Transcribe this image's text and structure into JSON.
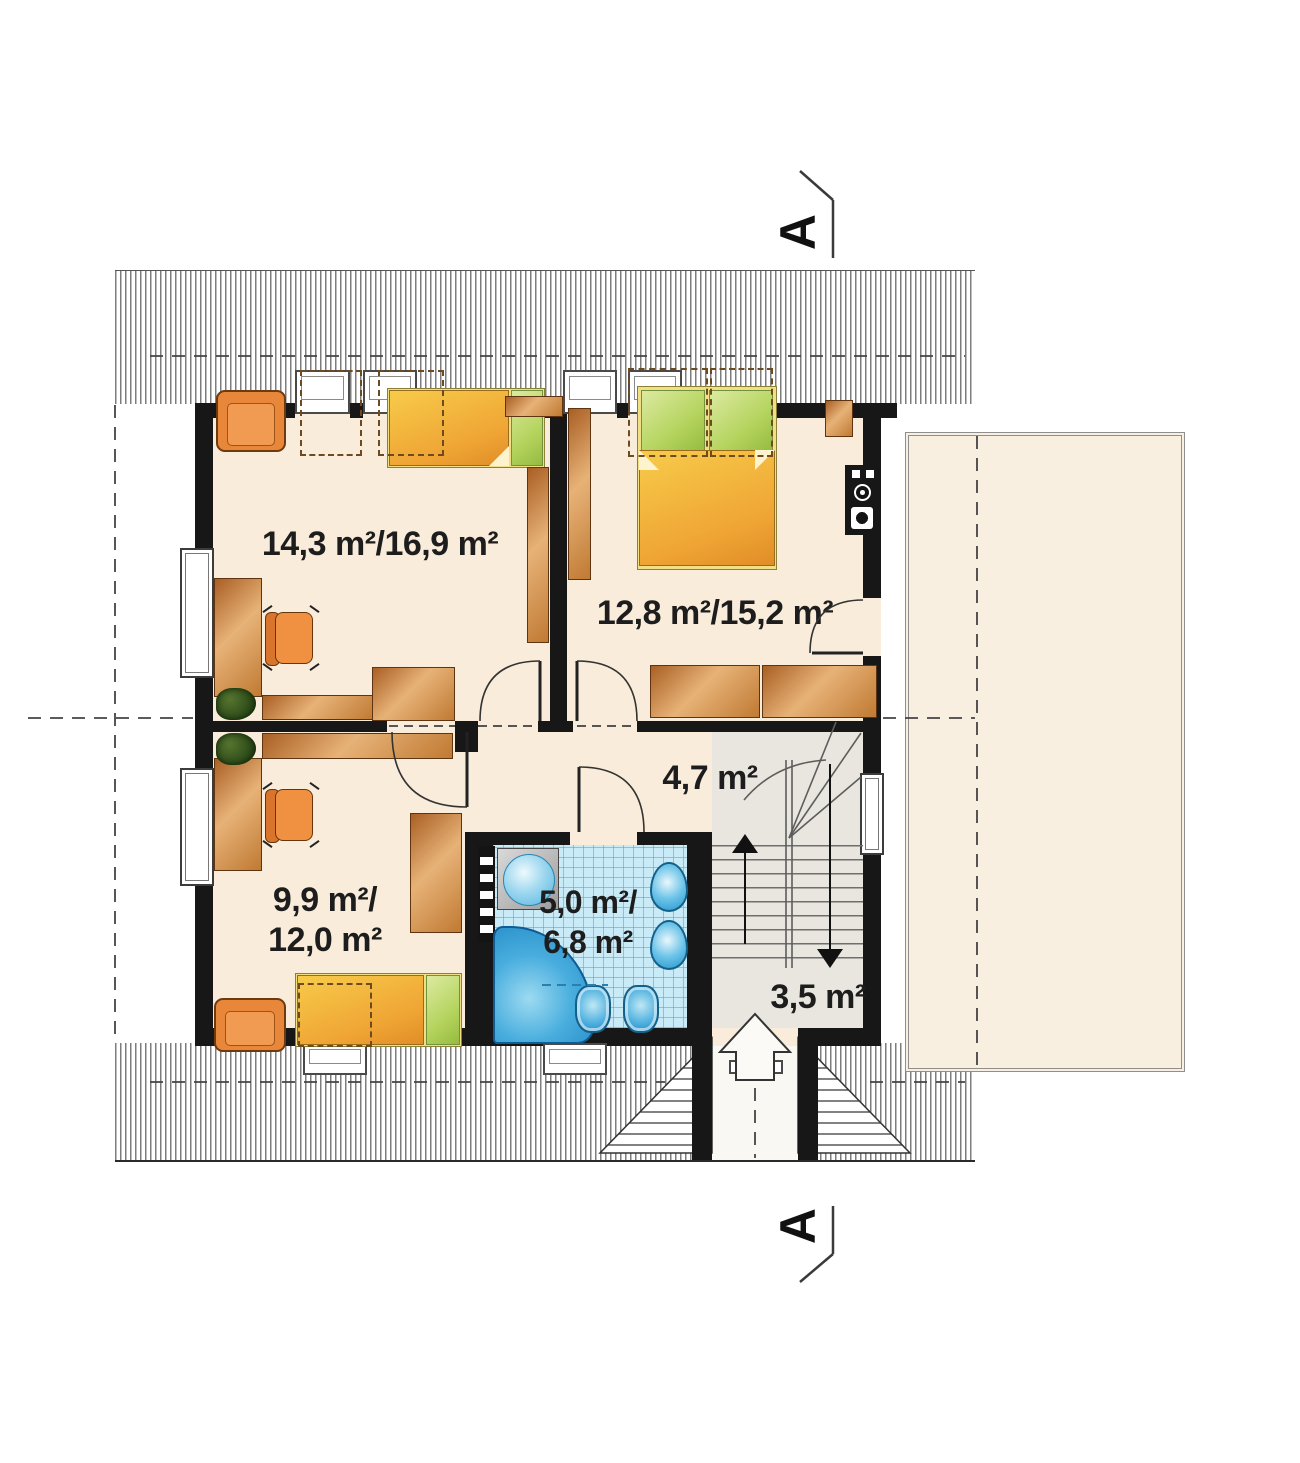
{
  "section": {
    "letter": "A"
  },
  "rooms": {
    "room_top_left": {
      "area": "14,3 m²/16,9 m²"
    },
    "bedroom": {
      "area": "12,8 m²/15,2 m²"
    },
    "room_bottom_left": {
      "area_line1": "9,9 m²/",
      "area_line2": "12,0 m²"
    },
    "bathroom": {
      "area_line1": "5,0 m²/",
      "area_line2": "6,8 m²"
    },
    "hall": {
      "area": "4,7 m²"
    },
    "landing": {
      "area": "3,5 m²"
    }
  },
  "colors": {
    "floor": "#f9ecda",
    "stair_floor": "#e9e6df",
    "bath_tile": "#c9ebf7",
    "wall": "#171717",
    "wood": "#c07a33",
    "upholstery_orange": "#e8863a",
    "bed_blanket": "#efa434",
    "pillow_green": "#b5d45f",
    "fixture_blue": "#49aede",
    "terrace": "#f8efe0"
  }
}
